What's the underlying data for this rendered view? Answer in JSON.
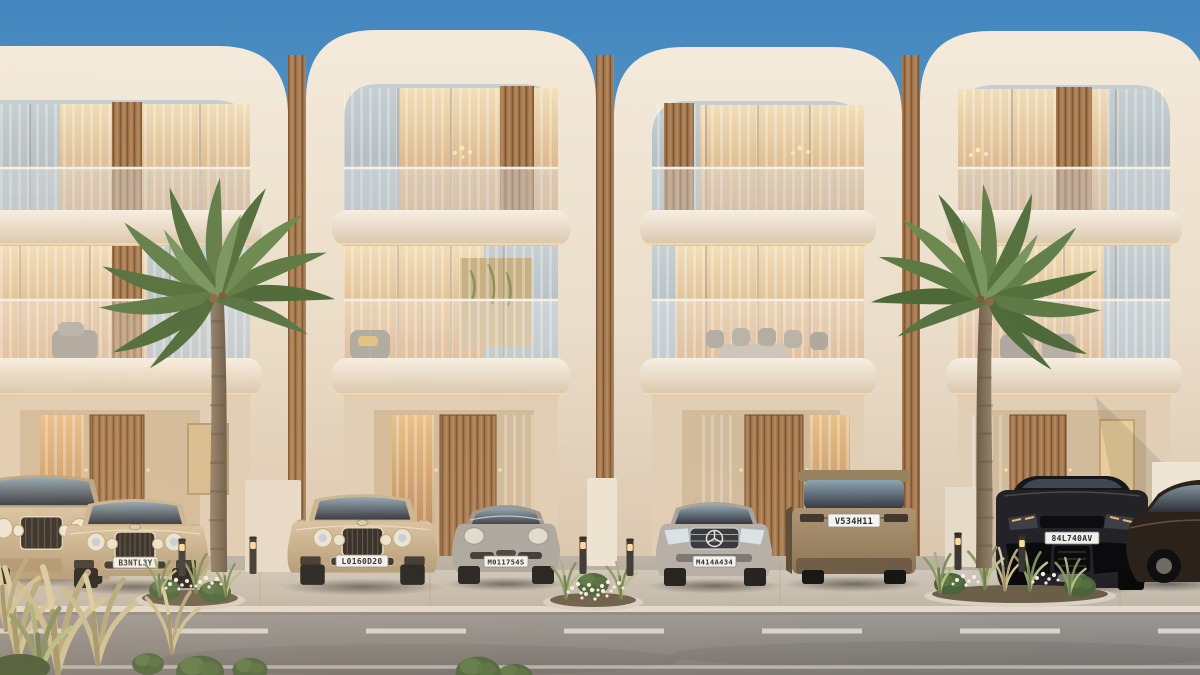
{
  "scene": {
    "title": "Luxury townhouse row with parked cars",
    "description": "Photorealistic dusk render of four modern cream townhouses with rounded facade frames, wood slat accents, glass balconies, two palm trees, luxury cars parked along the street",
    "time_of_day": "dusk",
    "units_count": 4,
    "palm_trees_count": 2,
    "bollard_lights_count": 6
  },
  "palette": {
    "sky_top": "#4286BE",
    "sky_horizon": "#7FB0D4",
    "facade_cream": "#EDE2D2",
    "facade_shadow": "#D3BFA9",
    "wood_slat": "#A87C52",
    "interior_glow": "#E9C089",
    "road_asphalt": "#8E8B88",
    "sidewalk": "#CCC4B7",
    "palm_green": "#5D7A47"
  },
  "buildings": {
    "units": [
      {
        "label": "townhouse-unit-1",
        "floors": 3,
        "balconies": 2
      },
      {
        "label": "townhouse-unit-2",
        "floors": 3,
        "balconies": 2
      },
      {
        "label": "townhouse-unit-3",
        "floors": 3,
        "balconies": 2
      },
      {
        "label": "townhouse-unit-4",
        "floors": 3,
        "balconies": 2
      }
    ]
  },
  "vehicles": [
    {
      "name": "bentley-bentayga-suv",
      "color": "champagne"
    },
    {
      "name": "bentley-flying-spur",
      "color": "champagne",
      "plate": "B3NTL3Y"
    },
    {
      "name": "bentley-flying-spur-2",
      "color": "gold",
      "plate": "L0160D20"
    },
    {
      "name": "porsche-911",
      "color": "grey",
      "plate": "M011754S"
    },
    {
      "name": "mercedes-benz-sedan",
      "color": "silver",
      "plate": "M414A434"
    },
    {
      "name": "range-rover",
      "color": "bronze",
      "plate": "V534H11"
    },
    {
      "name": "lamborghini-urus",
      "color": "black",
      "plate": "84L740AV"
    },
    {
      "name": "dark-luxury-sedan",
      "color": "dark-brown"
    }
  ],
  "road": {
    "marking": "dashed white center line",
    "edge_line": "solid white"
  }
}
